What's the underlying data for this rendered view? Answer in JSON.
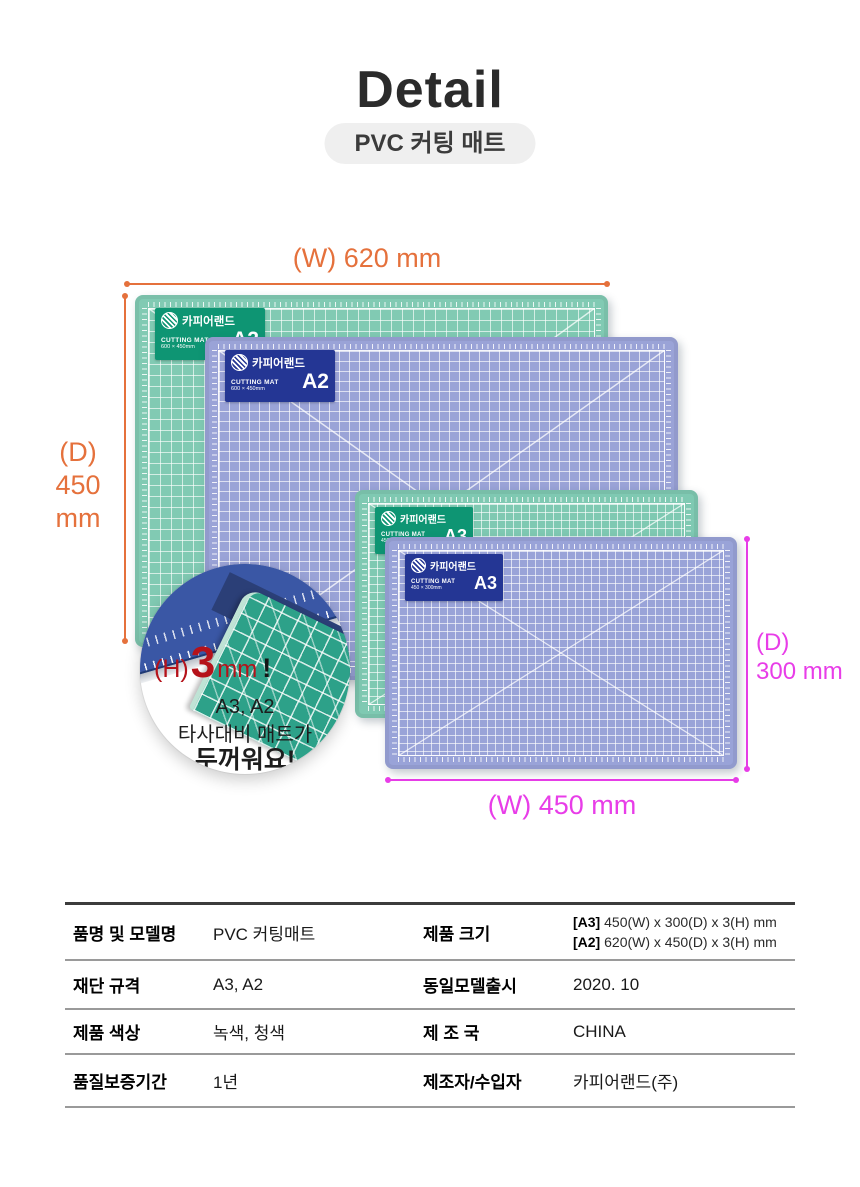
{
  "page": {
    "title": "Detail",
    "subtitle": "PVC 커팅 매트"
  },
  "annotations": {
    "top_width": "(W) 620 mm",
    "left_depth_line1": "(D)",
    "left_depth_line2": "450 mm",
    "right_depth_line1": "(D)",
    "right_depth_line2": "300 mm",
    "bottom_width": "(W) 450 mm"
  },
  "mats": [
    {
      "name": "green-a2",
      "brand": "카피어랜드",
      "product": "CUTTING MAT",
      "size": "A2",
      "dims": "600 × 450mm",
      "mat_color": "#81cab3",
      "badge_color": "#0e9573"
    },
    {
      "name": "purple-a2",
      "brand": "카피어랜드",
      "product": "CUTTING MAT",
      "size": "A2",
      "dims": "600 × 450mm",
      "mat_color": "#9aa3d7",
      "badge_color": "#243694"
    },
    {
      "name": "green-a3",
      "brand": "카피어랜드",
      "product": "CUTTING MAT",
      "size": "A3",
      "dims": "450 × 300mm",
      "mat_color": "#7fc9b2",
      "badge_color": "#0e9573"
    },
    {
      "name": "purple-a3",
      "brand": "카피어랜드",
      "product": "CUTTING MAT",
      "size": "A3",
      "dims": "450 × 300mm",
      "mat_color": "#99a3d8",
      "badge_color": "#243694"
    }
  ],
  "callout": {
    "h_label": "(H)",
    "h_value": "3",
    "h_unit": "mm",
    "h_mark": "!",
    "line1": "A3, A2",
    "line2": "타사대비 매트가",
    "line3": "두꺼워요!"
  },
  "spec_table": {
    "rows": [
      {
        "label1": "품명 및 모델명",
        "value1": "PVC 커팅매트",
        "label2": "제품 크기",
        "size_a3_tag": "[A3]",
        "size_a3_text": "450(W) x 300(D) x 3(H) mm",
        "size_a2_tag": "[A2]",
        "size_a2_text": "620(W) x 450(D) x 3(H) mm"
      },
      {
        "label1": "재단 규격",
        "value1": "A3, A2",
        "label2": "동일모델출시",
        "value2": "2020. 10"
      },
      {
        "label1": "제품 색상",
        "value1": "녹색, 청색",
        "label2": "제 조 국",
        "value2": "CHINA"
      },
      {
        "label1": "품질보증기간",
        "value1": "1년",
        "label2": "제조자/수입자",
        "value2": "카피어랜드(주)"
      }
    ]
  },
  "colors": {
    "orange": "#e5713c",
    "magenta": "#e83de8",
    "red": "#b5121a",
    "title": "#2b2b2b",
    "pill_bg": "#efefef"
  }
}
